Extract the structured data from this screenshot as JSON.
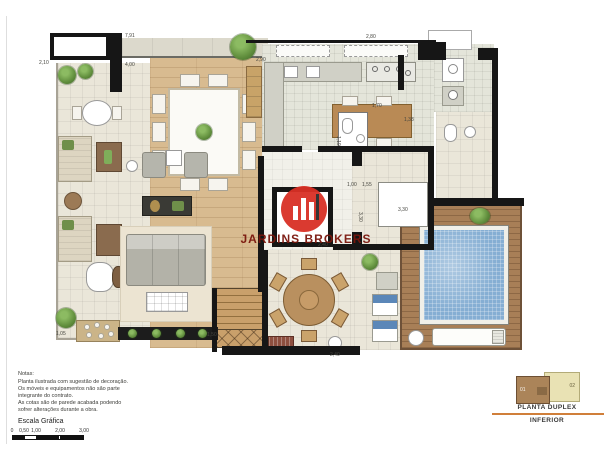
{
  "watermark": {
    "brand": "JARDINS BROKERS"
  },
  "colors": {
    "logo_red": "#d93025",
    "watermark_text": "#7a150c",
    "divider_orange": "#d07f3a",
    "pool_blue": "#85aed3",
    "wall_black": "#161616"
  },
  "plan": {
    "dimensions": [
      {
        "text": "7,91",
        "x": 125,
        "y": 33,
        "rot": 0
      },
      {
        "text": "4,00",
        "x": 125,
        "y": 62,
        "rot": 0
      },
      {
        "text": "2,10",
        "x": 39,
        "y": 60,
        "rot": 0
      },
      {
        "text": "2,90",
        "x": 256,
        "y": 57,
        "rot": 0
      },
      {
        "text": "2,80",
        "x": 366,
        "y": 34,
        "rot": 0
      },
      {
        "text": "1,70",
        "x": 372,
        "y": 103,
        "rot": 0
      },
      {
        "text": "1,38",
        "x": 404,
        "y": 117,
        "rot": 0
      },
      {
        "text": "1,00",
        "x": 347,
        "y": 182,
        "rot": 0
      },
      {
        "text": "1,55",
        "x": 362,
        "y": 182,
        "rot": 0
      },
      {
        "text": "3,30",
        "x": 398,
        "y": 207,
        "rot": 0
      },
      {
        "text": "2,40",
        "x": 318,
        "y": 242,
        "rot": 0
      },
      {
        "text": "2,40",
        "x": 330,
        "y": 352,
        "rot": 0
      },
      {
        "text": "1,05",
        "x": 56,
        "y": 331,
        "rot": 0
      },
      {
        "text": "1,50",
        "x": 207,
        "y": 332,
        "rot": 0
      },
      {
        "text": "3,30",
        "x": 363,
        "y": 212,
        "rot": 90
      },
      {
        "text": "1,19",
        "x": 341,
        "y": 136,
        "rot": 90
      }
    ]
  },
  "notes": {
    "title": "Notas:",
    "lines": [
      "Planta ilustrada com sugestão de decoração.",
      "Os móveis e equipamentos não são parte",
      "integrante do contrato.",
      "As cotas são de parede acabada podendo",
      "sofrer alterações durante a obra."
    ]
  },
  "scale": {
    "label": "Escala Gráfica",
    "ticks": [
      {
        "label": "0",
        "x": 0
      },
      {
        "label": "0,50",
        "x": 12
      },
      {
        "label": "1,00",
        "x": 24
      },
      {
        "label": "2,00",
        "x": 48
      },
      {
        "label": "3,00",
        "x": 72
      }
    ]
  },
  "title_block": {
    "title": "PLANTA DUPLEX",
    "subtitle": "INFERIOR",
    "units": [
      {
        "id": "01"
      },
      {
        "id": "02"
      }
    ]
  }
}
